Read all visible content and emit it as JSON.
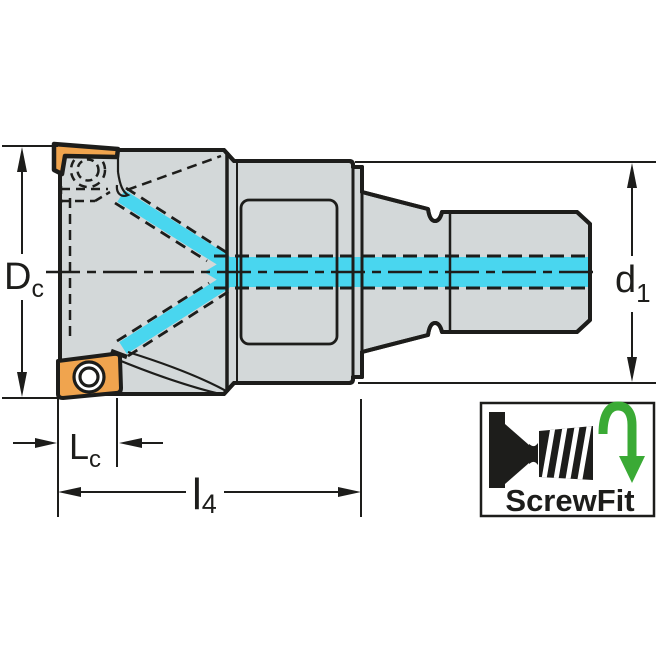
{
  "labels": {
    "dc": {
      "main": "D",
      "sub": "c"
    },
    "d1": {
      "main": "d",
      "sub": "1"
    },
    "lc": {
      "main": "L",
      "sub": "c"
    },
    "l4": {
      "main": "l",
      "sub": "4"
    },
    "badge": {
      "text": "ScrewFit"
    }
  },
  "colors": {
    "body_fill": "#d3d8d9",
    "insert_fill": "#f0a44e",
    "coolant_fill": "#49d6ef",
    "line": "#1d1d1b",
    "badge_arrow_green": "#3aaa35",
    "background": "#ffffff"
  },
  "icons": {
    "badge_tool": "screwfit-tool-silhouette-icon",
    "badge_arrow": "rotation-arrow-down-icon"
  }
}
